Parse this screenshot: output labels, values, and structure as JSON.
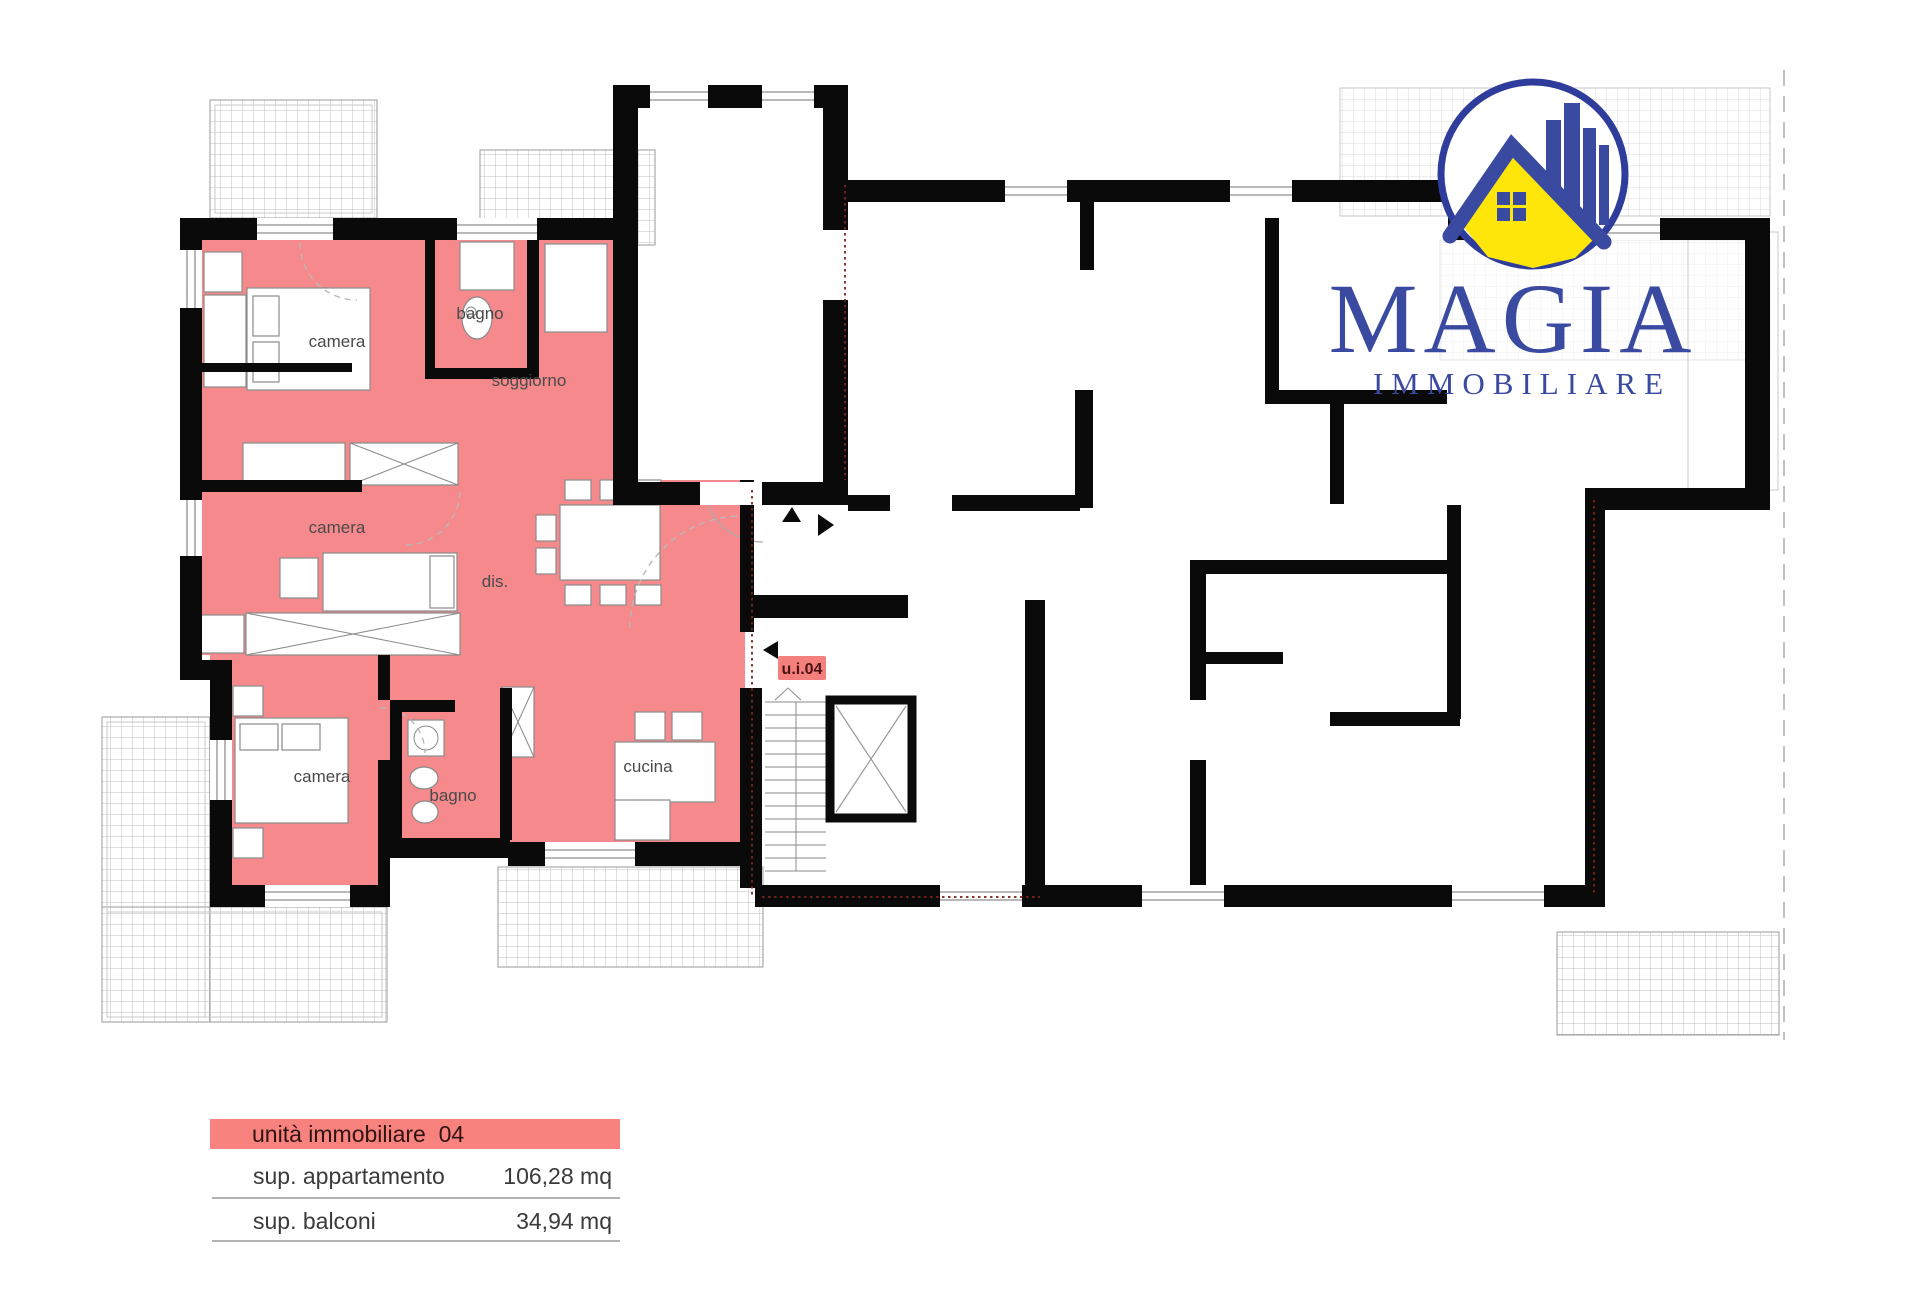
{
  "logo": {
    "name": "MAGIA",
    "subtitle": "IMMOBILIARE",
    "primary_color": "#3A4AA1",
    "circle_color": "#2E3D9B",
    "house_color": "#FFE60A"
  },
  "floor_plan": {
    "unit_tag": "u.i.04",
    "highlight_color": "#F5898B",
    "tag_color": "#F4807E",
    "rooms": [
      {
        "id": "camera-1",
        "label": "camera"
      },
      {
        "id": "bagno-1",
        "label": "bagno"
      },
      {
        "id": "soggiorno",
        "label": "soggiorno"
      },
      {
        "id": "camera-2",
        "label": "camera"
      },
      {
        "id": "disimpegno",
        "label": "dis."
      },
      {
        "id": "camera-3",
        "label": "camera"
      },
      {
        "id": "bagno-2",
        "label": "bagno"
      },
      {
        "id": "cucina",
        "label": "cucina"
      }
    ]
  },
  "legend": {
    "header": "unità immobiliare  04",
    "header_bg": "#F8827E",
    "rows": [
      {
        "label": "sup. appartamento",
        "value": "106,28 mq"
      },
      {
        "label": "sup. balconi",
        "value": "34,94 mq"
      }
    ]
  }
}
